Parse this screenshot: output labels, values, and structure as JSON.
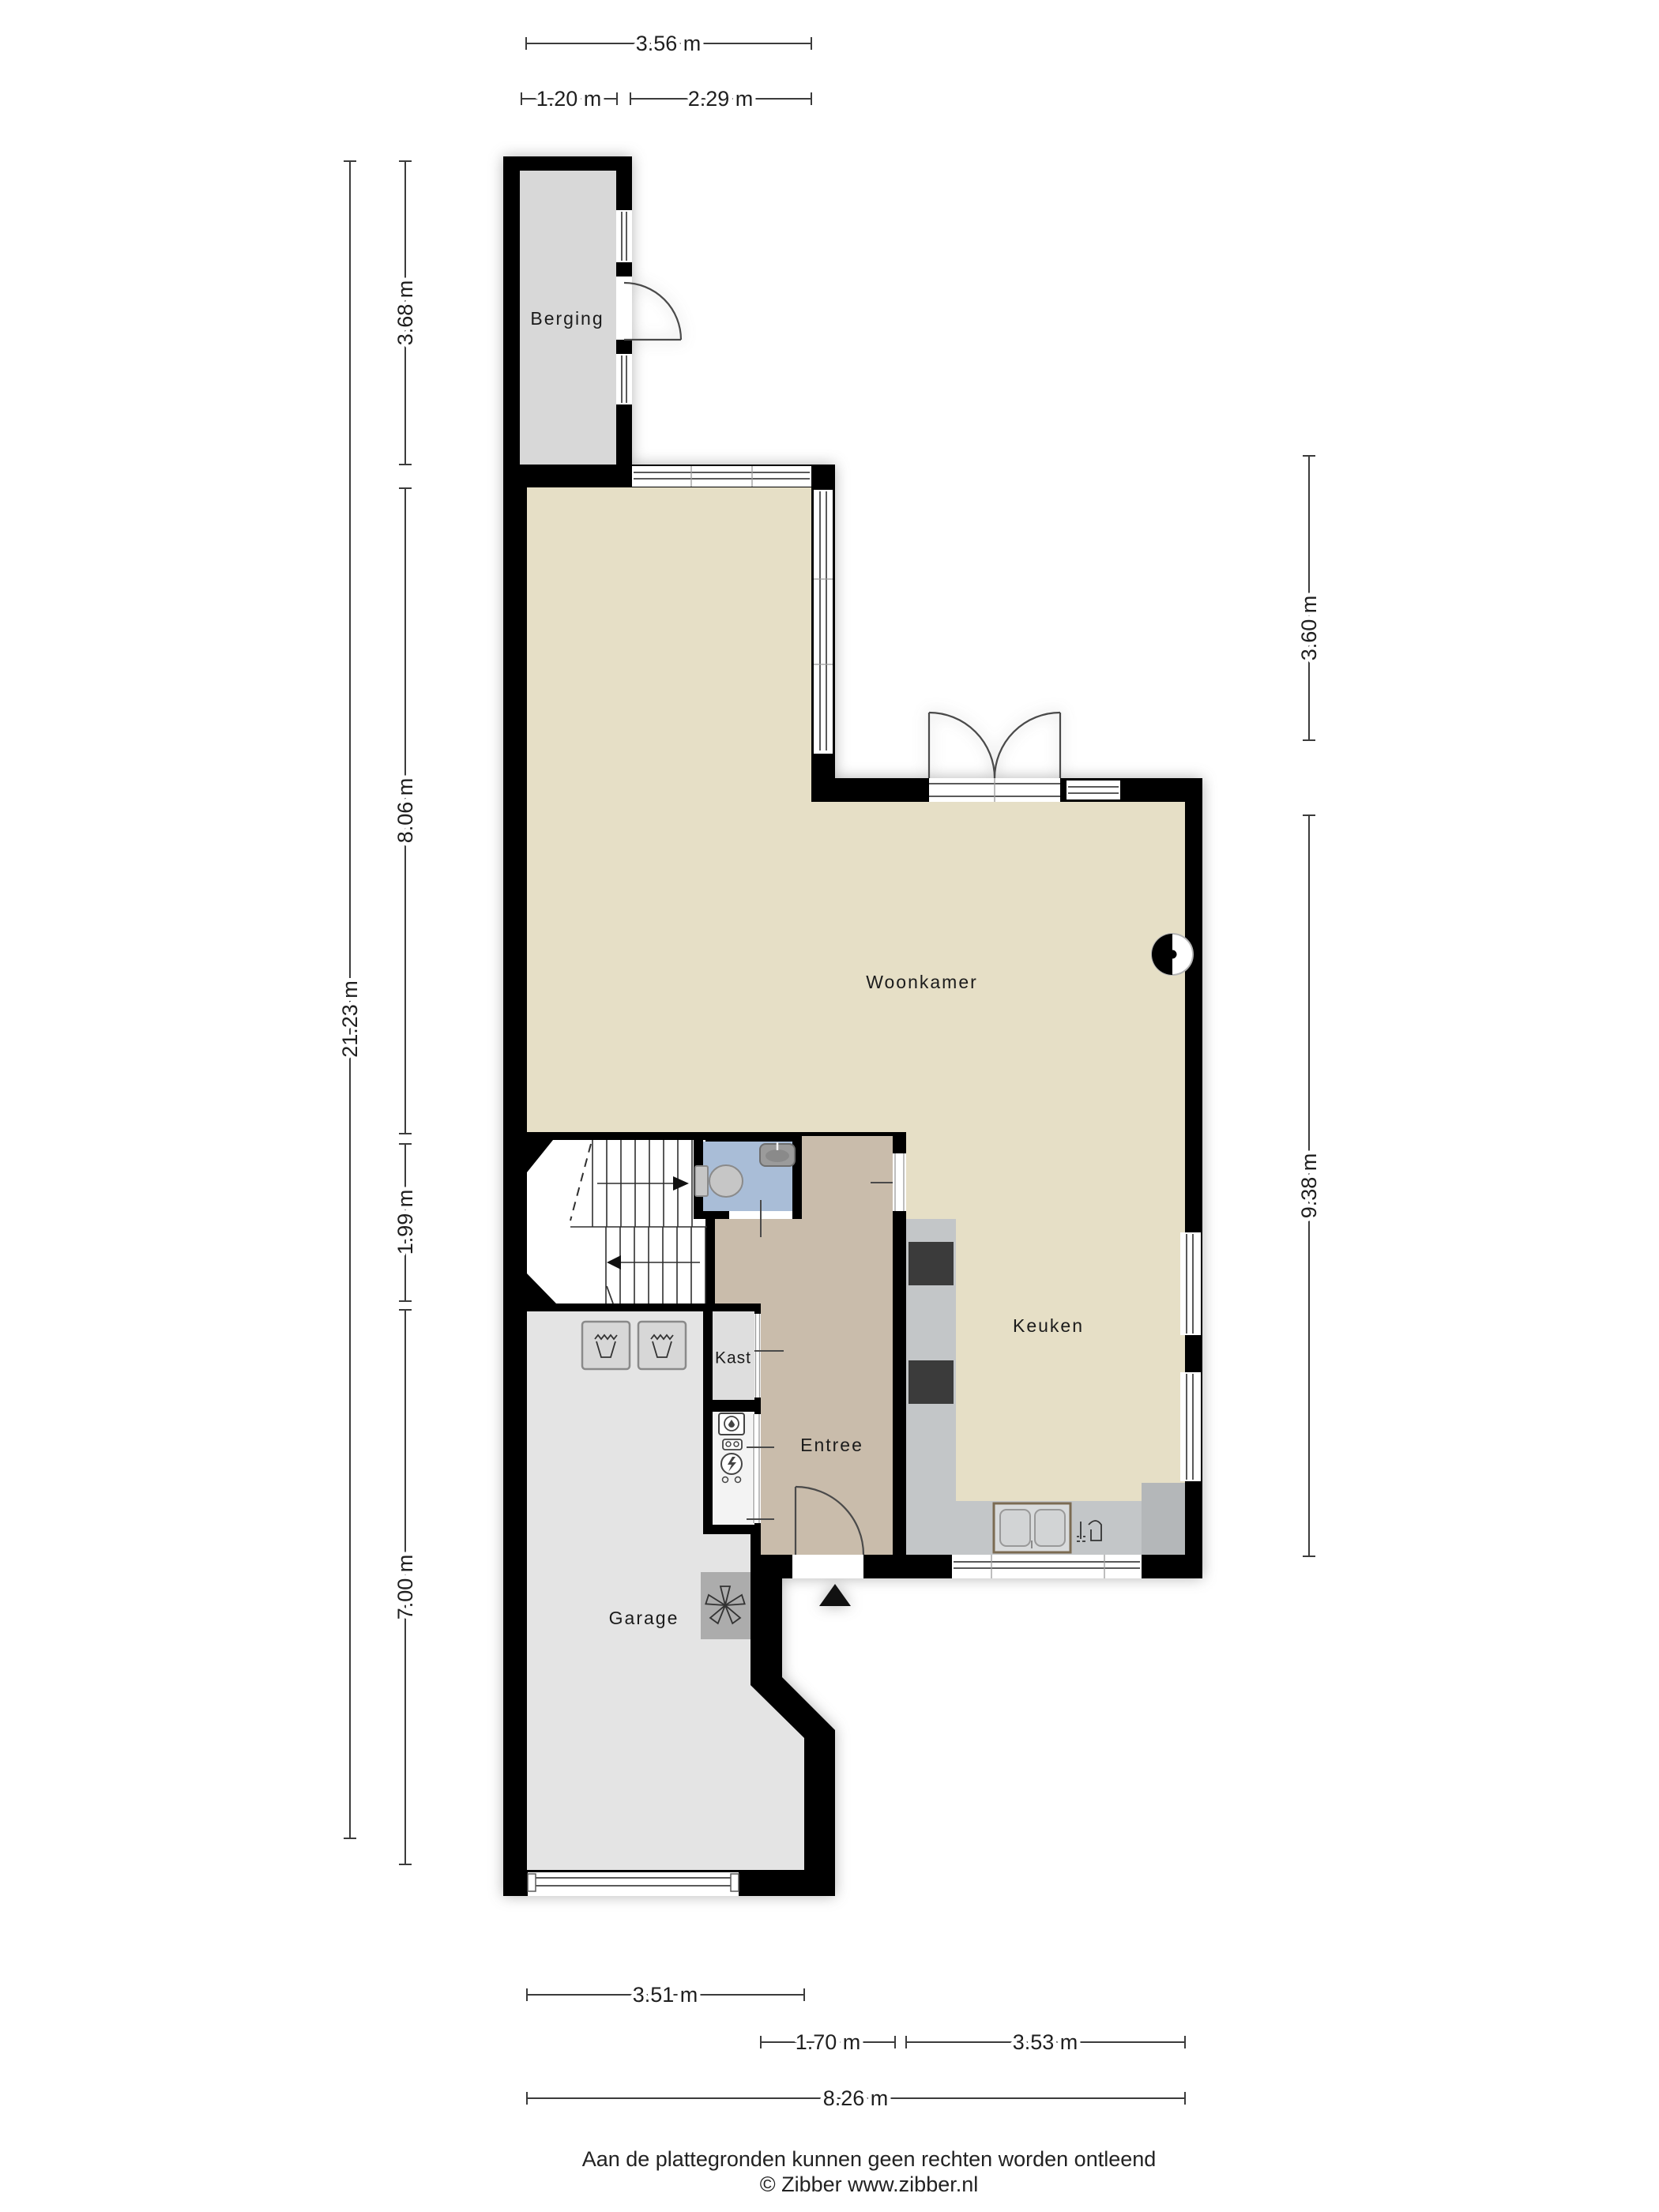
{
  "plan": {
    "rooms": {
      "berging": "Berging",
      "woonkamer": "Woonkamer",
      "keuken": "Keuken",
      "entree": "Entree",
      "kast": "Kast",
      "garage": "Garage"
    }
  },
  "dimensions": {
    "top_total": "3.56 m",
    "top_berging": "1.20 m",
    "top_right": "2.29 m",
    "left_total": "21.23 m",
    "left_berging": "3.68 m",
    "left_woonkamer": "8.06 m",
    "left_hal": "1.99 m",
    "left_garage": "7.00 m",
    "right_top": "3.60 m",
    "right_bottom": "9.38 m",
    "bottom_garage": "3.51 m",
    "bottom_entree": "1.70 m",
    "bottom_keuken": "3.53 m",
    "bottom_total": "8.26 m"
  },
  "footer": {
    "disclaimer": "Aan de plattegronden kunnen geen rechten worden ontleend",
    "copyright": "© Zibber www.zibber.nl"
  },
  "icons": [
    "toilet-icon",
    "sink-icon",
    "washing-machine-icon",
    "ventilation-fan-icon",
    "entrance-arrow-icon",
    "stairs-up-arrow-icon",
    "stairs-down-arrow-icon",
    "wall-boiler-icon",
    "electric-meter-icon",
    "water-meter-icon",
    "kitchen-sink-icon",
    "kitchen-tap-icon",
    "cooktop-icon"
  ],
  "colors": {
    "wall": "#000000",
    "floor-living": "#e6dfc6",
    "floor-entree": "#c9bcab",
    "floor-toilet": "#a9bdd7",
    "floor-berging": "#d8d8d8",
    "floor-garage": "#e4e4e4",
    "floor-kast": "#dedede",
    "counter": "#c3c6c8",
    "counter-dark": "#b4b7b9",
    "appliance": "#3b3b3b",
    "fan-box": "#acacac",
    "dim-line": "#3c3c3c"
  }
}
